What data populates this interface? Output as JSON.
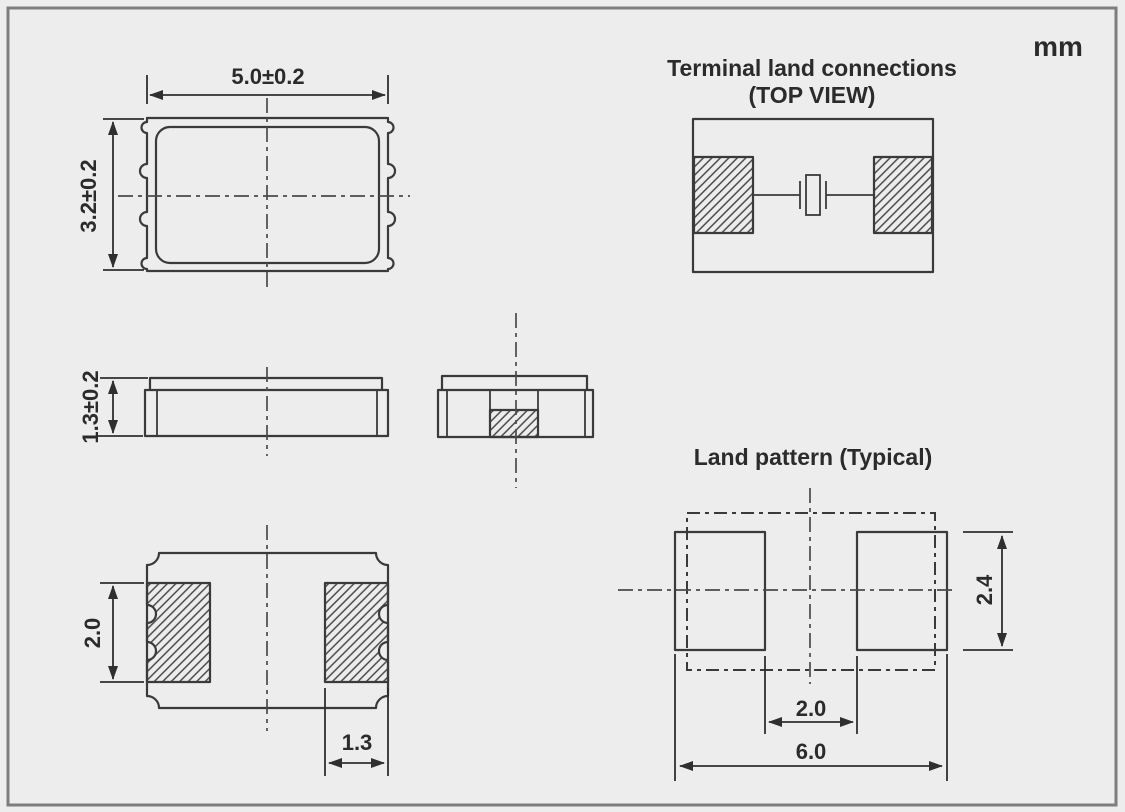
{
  "unit_label": "mm",
  "views": {
    "top_view": {
      "width_dim": "5.0±0.2",
      "height_dim": "3.2±0.2"
    },
    "side_view": {
      "thickness_dim": "1.3±0.2"
    },
    "bottom_view": {
      "pad_length_dim": "2.0",
      "pad_width_dim": "1.3"
    },
    "terminal_land_connections": {
      "title": "Terminal land connections",
      "subtitle": "(TOP VIEW)"
    },
    "land_pattern": {
      "title": "Land pattern (Typical)",
      "pad_height_dim": "2.4",
      "pad_gap_dim": "2.0",
      "overall_width_dim": "6.0"
    }
  },
  "colors": {
    "background": "#ededed",
    "line_color": "#3a3a3a",
    "frame_color": "#7d7d7d",
    "text_color": "#2b2b2b"
  }
}
